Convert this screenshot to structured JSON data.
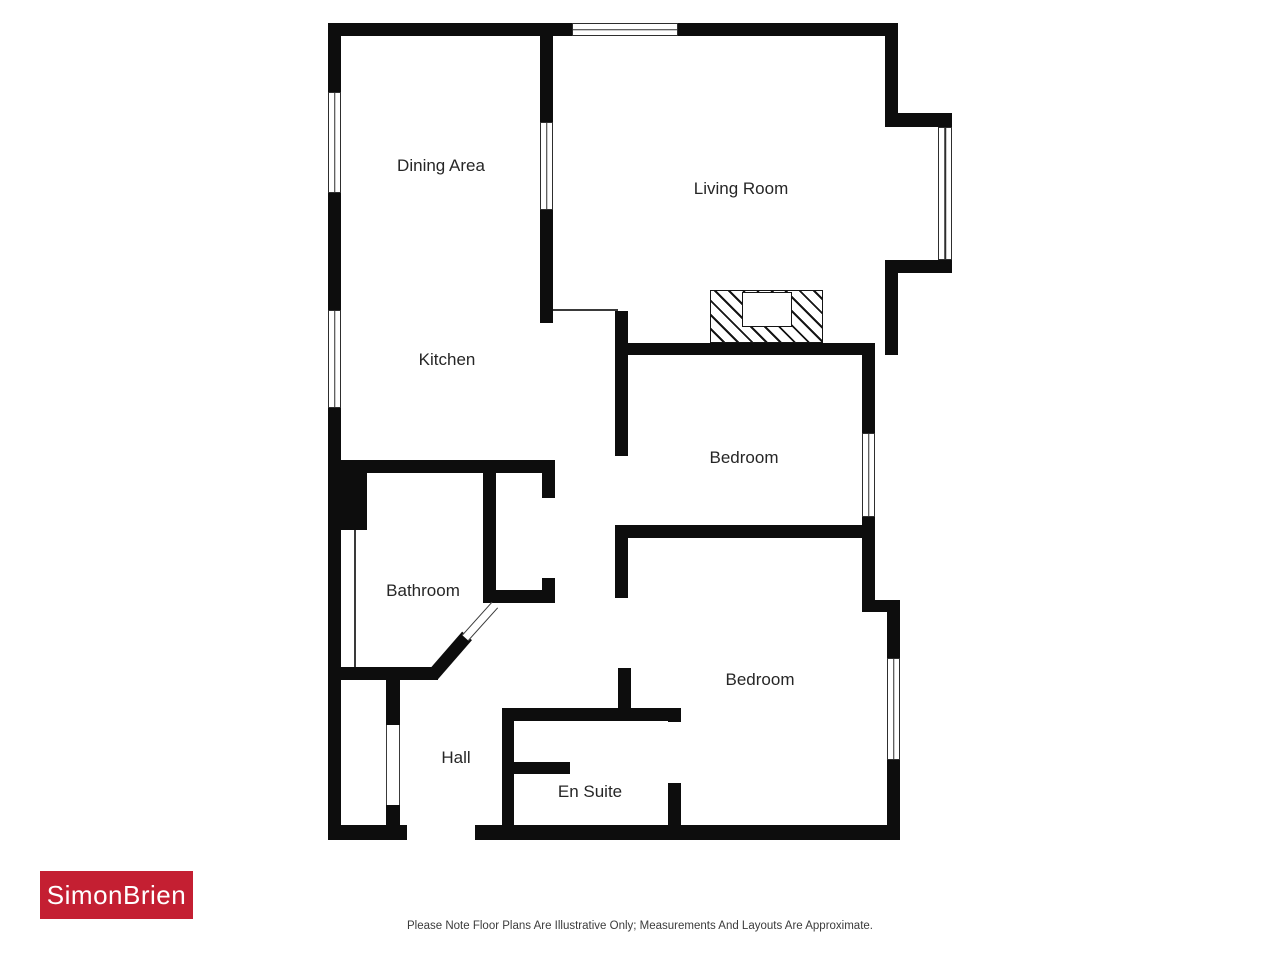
{
  "floorplan": {
    "rooms": [
      {
        "id": "dining-area",
        "label": "Dining Area"
      },
      {
        "id": "kitchen",
        "label": "Kitchen"
      },
      {
        "id": "living-room",
        "label": "Living Room"
      },
      {
        "id": "bedroom-1",
        "label": "Bedroom"
      },
      {
        "id": "bedroom-2",
        "label": "Bedroom"
      },
      {
        "id": "bathroom",
        "label": "Bathroom"
      },
      {
        "id": "hall",
        "label": "Hall"
      },
      {
        "id": "en-suite",
        "label": "En Suite"
      }
    ],
    "wall_color": "#0d0d0d"
  },
  "branding": {
    "logo_text": "SimonBrien",
    "logo_background": "#c41f32",
    "logo_text_color": "#ffffff"
  },
  "footer": {
    "disclaimer": "Please Note Floor Plans Are Illustrative Only; Measurements And Layouts Are Approximate."
  }
}
